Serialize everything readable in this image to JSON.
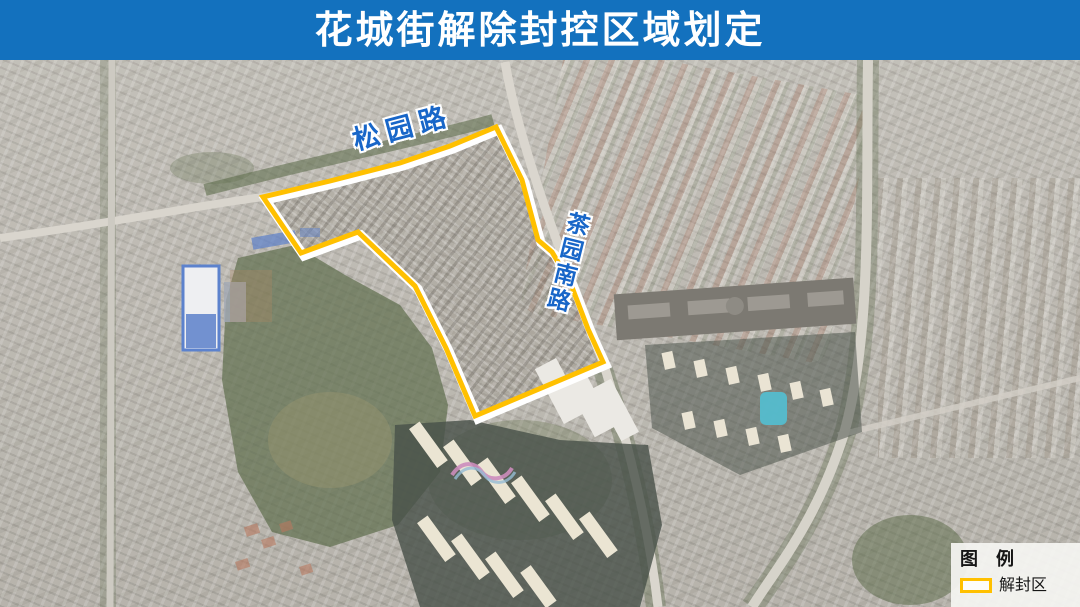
{
  "title": {
    "text": "花城街解除封控区域划定"
  },
  "colors": {
    "banner_bg": "#1371BE",
    "banner_text": "#FFFFFF",
    "zone_outline": "#FFC000",
    "zone_casing": "#FFFFFF",
    "road_label": "#1866C8",
    "legend_bg": "#F5F5F2",
    "legend_text": "#161616"
  },
  "map": {
    "type": "satellite-imagery",
    "road_labels": [
      {
        "name": "songyuan-road",
        "text": "松园路",
        "orientation": "diagonal"
      },
      {
        "name": "chayuan-south-road",
        "text": "茶园南路",
        "orientation": "vertical"
      }
    ],
    "zone_polygon_points": "496,67 450,86 400,103 330,121 263,137 301,193 358,172 415,226 446,288 475,356 603,302 588,269 570,222 552,192 538,180 522,120"
  },
  "legend": {
    "title": "图　例",
    "items": [
      {
        "name": "unsealed-zone",
        "swatch_color": "#FFC000",
        "label": "解封区"
      }
    ]
  }
}
